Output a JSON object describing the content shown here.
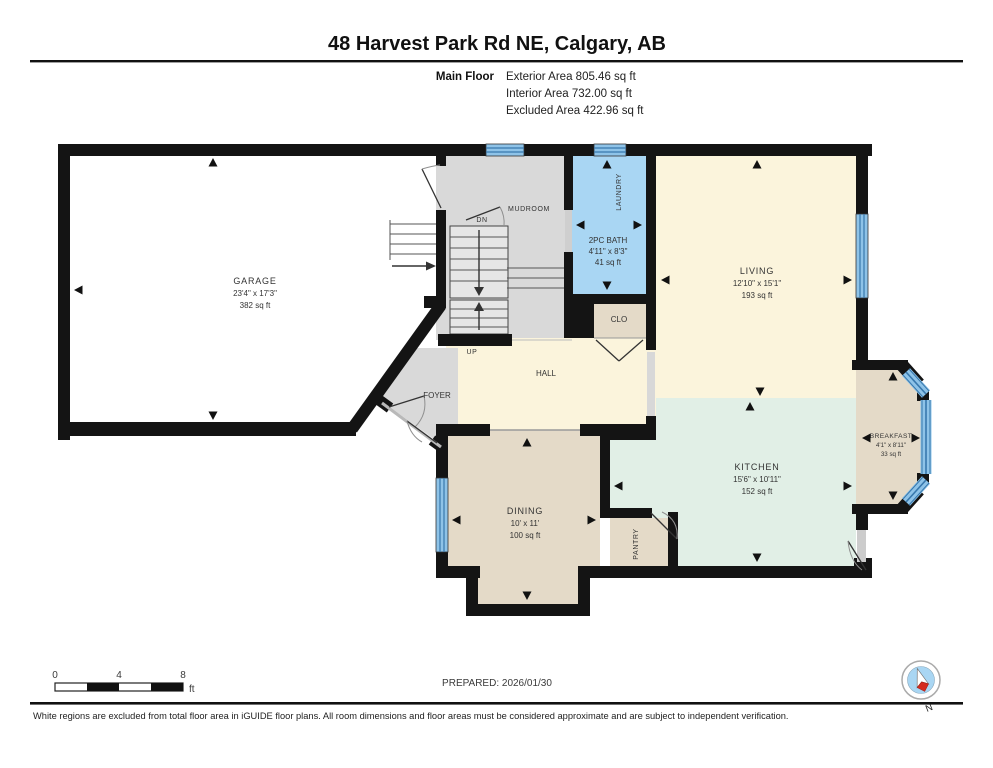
{
  "header": {
    "title": "48 Harvest Park Rd NE, Calgary, AB",
    "floor_label": "Main Floor",
    "exterior": "Exterior Area 805.46 sq ft",
    "interior": "Interior Area 732.00 sq ft",
    "excluded": "Excluded Area 422.96 sq ft"
  },
  "rooms": {
    "garage": {
      "name": "GARAGE",
      "dims": "23'4\" x 17'3\"",
      "area": "382 sq ft"
    },
    "mudroom": {
      "name": "MUDROOM"
    },
    "laundry": {
      "name": "LAUNDRY"
    },
    "bath": {
      "name": "2PC BATH",
      "dims": "4'11\" x 8'3\"",
      "area": "41 sq ft"
    },
    "closet": {
      "name": "CLO"
    },
    "living": {
      "name": "LIVING",
      "dims": "12'10\" x 15'1\"",
      "area": "193 sq ft"
    },
    "hall": {
      "name": "HALL"
    },
    "foyer": {
      "name": "FOYER"
    },
    "dining": {
      "name": "DINING",
      "dims": "10' x 11'",
      "area": "100 sq ft"
    },
    "pantry": {
      "name": "PANTRY"
    },
    "kitchen": {
      "name": "KITCHEN",
      "dims": "15'6\" x 10'11\"",
      "area": "152 sq ft"
    },
    "breakfast": {
      "name": "BREAKFAST",
      "dims": "4'1\" x 8'11\"",
      "area": "33 sq ft"
    },
    "stairs": {
      "up": "UP",
      "down": "DN"
    }
  },
  "footer": {
    "scale": {
      "zero": "0",
      "four": "4",
      "eight": "8",
      "unit": "ft"
    },
    "prepared": "PREPARED: 2026/01/30",
    "compass": {
      "label": "N"
    },
    "disclaimer": "White regions are excluded from total floor area in iGUIDE floor plans. All room dimensions and floor areas must be considered approximate and are subject to independent verification."
  },
  "colors": {
    "wall": "#141414",
    "window": "#8ec3e8",
    "window_line": "#3878ad",
    "room_gray": "#d9d9d9",
    "room_cream": "#fbf4dc",
    "room_blue": "#a9d6f3",
    "room_mint": "#e1efe6",
    "room_tan": "#e4dac8",
    "excluded_white": "#ffffff",
    "compass_blue": "#a9d6f3",
    "compass_red": "#d42b1e"
  }
}
